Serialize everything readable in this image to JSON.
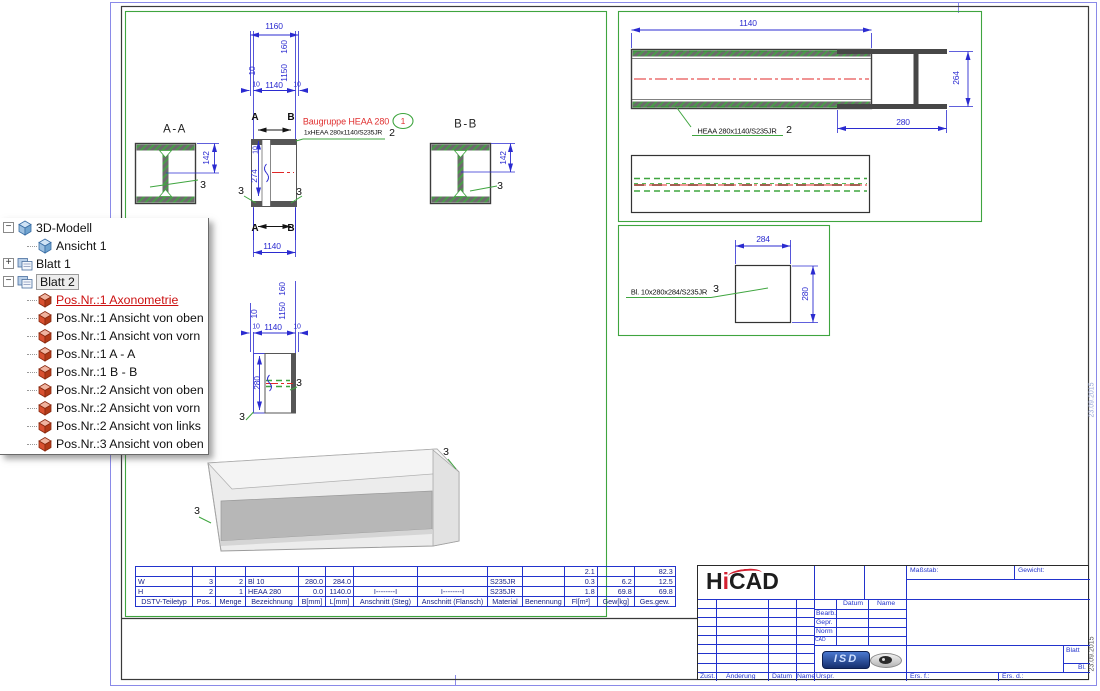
{
  "tree": {
    "items": [
      {
        "label": "3D-Modell",
        "level": 0,
        "icon": "cube-blue",
        "expander": "minus"
      },
      {
        "label": "Ansicht 1",
        "level": 1,
        "icon": "cube-blue"
      },
      {
        "label": "Blatt 1",
        "level": 0,
        "icon": "sheet",
        "expander": "plus"
      },
      {
        "label": "Blatt 2",
        "level": 0,
        "icon": "sheet",
        "expander": "minus",
        "selected": true
      },
      {
        "label": "Pos.Nr.:1 Axonometrie",
        "level": 1,
        "icon": "cube-red",
        "active_red": true
      },
      {
        "label": "Pos.Nr.:1 Ansicht von oben",
        "level": 1,
        "icon": "cube-red"
      },
      {
        "label": "Pos.Nr.:1 Ansicht von vorn",
        "level": 1,
        "icon": "cube-red"
      },
      {
        "label": "Pos.Nr.:1 A - A",
        "level": 1,
        "icon": "cube-red"
      },
      {
        "label": "Pos.Nr.:1 B - B",
        "level": 1,
        "icon": "cube-red"
      },
      {
        "label": "Pos.Nr.:2 Ansicht von oben",
        "level": 1,
        "icon": "cube-red"
      },
      {
        "label": "Pos.Nr.:2 Ansicht von vorn",
        "level": 1,
        "icon": "cube-red"
      },
      {
        "label": "Pos.Nr.:2 Ansicht von links",
        "level": 1,
        "icon": "cube-red"
      },
      {
        "label": "Pos.Nr.:3 Ansicht von oben",
        "level": 1,
        "icon": "cube-red"
      }
    ]
  },
  "annotations": [
    {
      "t": "1160",
      "x": 274,
      "y": 26
    },
    {
      "t": "10",
      "x": 252,
      "y": 71,
      "r": -90
    },
    {
      "t": "160",
      "x": 284,
      "y": 47,
      "r": -90
    },
    {
      "t": "1150",
      "x": 284,
      "y": 73,
      "r": -90
    },
    {
      "t": "10",
      "x": 256,
      "y": 85,
      "c": "dim7"
    },
    {
      "t": "1140",
      "x": 274,
      "y": 85
    },
    {
      "t": "10",
      "x": 297,
      "y": 85,
      "c": "dim7"
    },
    {
      "t": "A",
      "x": 255,
      "y": 118,
      "c": "sec"
    },
    {
      "t": "B",
      "x": 291,
      "y": 118,
      "c": "sec"
    },
    {
      "t": "A-A",
      "x": 175,
      "y": 130,
      "c": "view"
    },
    {
      "t": "B-B",
      "x": 466,
      "y": 125,
      "c": "view"
    },
    {
      "t": "Baugruppe HEAA 280",
      "x": 346,
      "y": 122,
      "c": "red"
    },
    {
      "t": "1",
      "x": 403,
      "y": 121,
      "c": "redS"
    },
    {
      "t": "1xHEAA 280x1140/S235JR",
      "x": 343,
      "y": 134,
      "c": "lbl7"
    },
    {
      "t": "2",
      "x": 392,
      "y": 133,
      "c": "big"
    },
    {
      "t": "142",
      "x": 206,
      "y": 158,
      "r": -90
    },
    {
      "t": "3",
      "x": 203,
      "y": 185,
      "c": "big"
    },
    {
      "t": "142",
      "x": 503,
      "y": 158,
      "r": -90
    },
    {
      "t": "3",
      "x": 500,
      "y": 186,
      "c": "big"
    },
    {
      "t": "10",
      "x": 256,
      "y": 150,
      "r": -90,
      "c": "dimr7"
    },
    {
      "t": "274",
      "x": 254,
      "y": 176,
      "r": -90
    },
    {
      "t": "3",
      "x": 241,
      "y": 191,
      "c": "big"
    },
    {
      "t": "3",
      "x": 299,
      "y": 192,
      "c": "big"
    },
    {
      "t": "A",
      "x": 255,
      "y": 229,
      "c": "sec"
    },
    {
      "t": "B",
      "x": 291,
      "y": 229,
      "c": "sec"
    },
    {
      "t": "1140",
      "x": 272,
      "y": 246
    },
    {
      "t": "160",
      "x": 282,
      "y": 289,
      "r": -90
    },
    {
      "t": "1150",
      "x": 282,
      "y": 311,
      "r": -90
    },
    {
      "t": "10",
      "x": 254,
      "y": 314,
      "r": -90
    },
    {
      "t": "10",
      "x": 256,
      "y": 327,
      "c": "dim7"
    },
    {
      "t": "1140",
      "x": 273,
      "y": 327
    },
    {
      "t": "10",
      "x": 297,
      "y": 327,
      "c": "dim7"
    },
    {
      "t": "280",
      "x": 257,
      "y": 383,
      "r": -90
    },
    {
      "t": "3",
      "x": 299,
      "y": 383,
      "c": "big"
    },
    {
      "t": "3",
      "x": 242,
      "y": 417,
      "c": "big"
    },
    {
      "t": "3",
      "x": 197,
      "y": 511,
      "c": "big"
    },
    {
      "t": "3",
      "x": 446,
      "y": 452,
      "c": "big"
    },
    {
      "t": "1140",
      "x": 748,
      "y": 23
    },
    {
      "t": "HEAA 280x1140/S235JR",
      "x": 737,
      "y": 131,
      "c": "lbl"
    },
    {
      "t": "2",
      "x": 789,
      "y": 130,
      "c": "big"
    },
    {
      "t": "264",
      "x": 956,
      "y": 78,
      "r": -90
    },
    {
      "t": "280",
      "x": 903,
      "y": 122
    },
    {
      "t": "284",
      "x": 763,
      "y": 239
    },
    {
      "t": "280",
      "x": 805,
      "y": 294,
      "r": -90
    },
    {
      "t": "Bl. 10x280x284/S235JR",
      "x": 669,
      "y": 292,
      "c": "lbl"
    },
    {
      "t": "3",
      "x": 716,
      "y": 289,
      "c": "big"
    },
    {
      "t": "23.09.2015",
      "x": 1092,
      "y": 654,
      "r": -90,
      "c": "date"
    },
    {
      "t": "23.09.2015",
      "x": 1092,
      "y": 400,
      "r": -90,
      "c": "date2"
    }
  ],
  "parts_table": {
    "columns": [
      "DSTV-Teiletyp",
      "Pos.",
      "Menge",
      "Bezeichnung",
      "B[mm]",
      "L[mm]",
      "Anschnitt (Steg)",
      "Anschnitt (Flansch)",
      "Material",
      "Benennung",
      "Fl[m²]",
      "Gew[kg]",
      "Ges.gew."
    ],
    "col_widths": [
      52,
      18,
      25,
      48,
      22,
      23,
      59,
      65,
      30,
      35,
      28,
      32,
      36
    ],
    "aligns": [
      "left",
      "right",
      "right",
      "left",
      "right",
      "right",
      "center",
      "center",
      "left",
      "left",
      "right",
      "right",
      "right"
    ],
    "rows": [
      [
        "",
        "",
        "",
        "",
        "",
        "",
        "",
        "",
        "",
        "",
        "2.1",
        "",
        "82.3"
      ],
      [
        "W",
        "3",
        "2",
        "Bl 10",
        "280.0",
        "284.0",
        "",
        "",
        "S235JR",
        "",
        "0.3",
        "6.2",
        "12.5"
      ],
      [
        "H",
        "2",
        "1",
        "HEAA 280",
        "0.0",
        "1140.0",
        "I--------I",
        "I--------I",
        "S235JR",
        "",
        "1.8",
        "69.8",
        "69.8"
      ]
    ]
  },
  "title_block": {
    "brand_h": "H",
    "brand_i": "i",
    "brand_cad": "CAD",
    "masstab_label": "Maßstab:",
    "gewicht_label": "Gewicht:",
    "datum_label": "Datum",
    "name_label": "Name",
    "bearb_label": "Bearb.",
    "gepr_label": "Gepr.",
    "norm_label": "Norm",
    "cad_label": "CAD",
    "urspr_label": "Urspr.",
    "zust_label": "Zust.",
    "aenderung_label": "Änderung",
    "datum2_label": "Datum",
    "name2_label": "Name",
    "ers_f_label": "Ers. f.:",
    "ers_d_label": "Ers. d.:",
    "blatt_label": "Blatt",
    "bl_label": "Bl.",
    "isd_logo": "ISD"
  },
  "colors": {
    "frame_green": "#3fa53f",
    "dim_blue": "#2b2bd0",
    "annotation_red": "#e03030",
    "table_blue": "#2233cc",
    "paper_blue": "#8a8ae8"
  }
}
